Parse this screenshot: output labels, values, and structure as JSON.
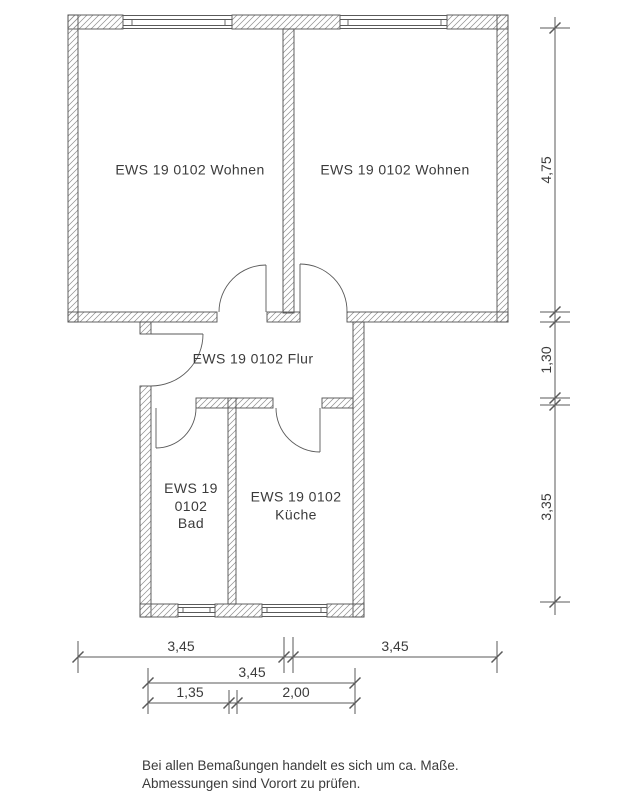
{
  "title": "Floor plan EWS 19 0102",
  "colors": {
    "background": "#ffffff",
    "wall_outline": "#4f4f4f",
    "hatch": "#8f8f8f",
    "dimension_line": "#5a5a5a",
    "text": "#3b3b3b"
  },
  "rooms": {
    "wohnen_left": "EWS 19 0102 Wohnen",
    "wohnen_right": "EWS 19 0102 Wohnen",
    "flur": "EWS 19 0102 Flur",
    "bad_line1": "EWS 19",
    "bad_line2": "0102",
    "bad_line3": "Bad",
    "kueche_line1": "EWS 19 0102",
    "kueche_line2": "Küche"
  },
  "dimensions": {
    "right_top": "4,75",
    "right_middle": "1,30",
    "right_bottom": "3,35",
    "bottom_row1_left": "3,45",
    "bottom_row1_right": "3,45",
    "bottom_row2": "3,45",
    "bottom_row3_left": "1,35",
    "bottom_row3_right": "2,00"
  },
  "notes": {
    "line1": "Bei allen Bemaßungen handelt es sich um ca. Maße.",
    "line2": "Abmessungen sind Vorort zu prüfen."
  }
}
